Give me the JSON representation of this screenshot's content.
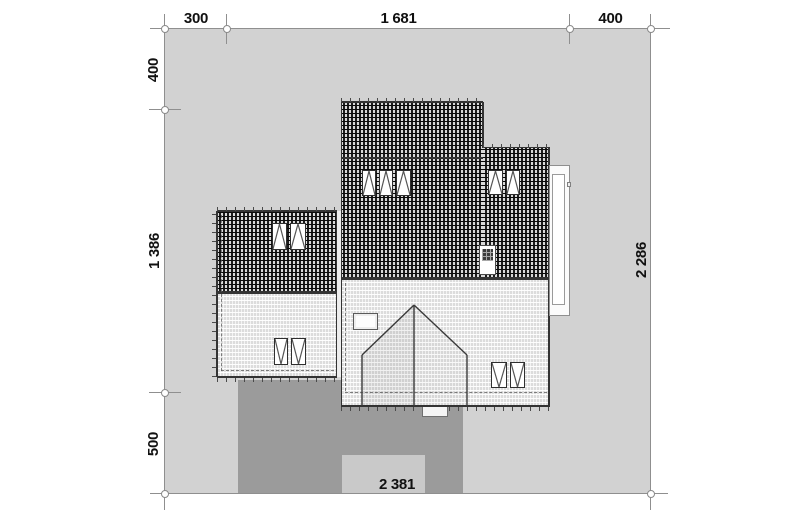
{
  "title": "House roof and site plan",
  "dimensions": {
    "top_left": "300",
    "top_middle": "1 681",
    "top_right": "400",
    "left_top": "400",
    "left_middle": "1 386",
    "left_bottom": "500",
    "right_total": "2 286",
    "bottom_total": "2 381"
  },
  "colors": {
    "background": "#ffffff",
    "plot": "#d2d2d2",
    "driveway": "#9b9b9b",
    "walkway": "#c9c9c9",
    "line": "#333333",
    "dim_line": "#8f8f8f",
    "text": "#111111"
  }
}
